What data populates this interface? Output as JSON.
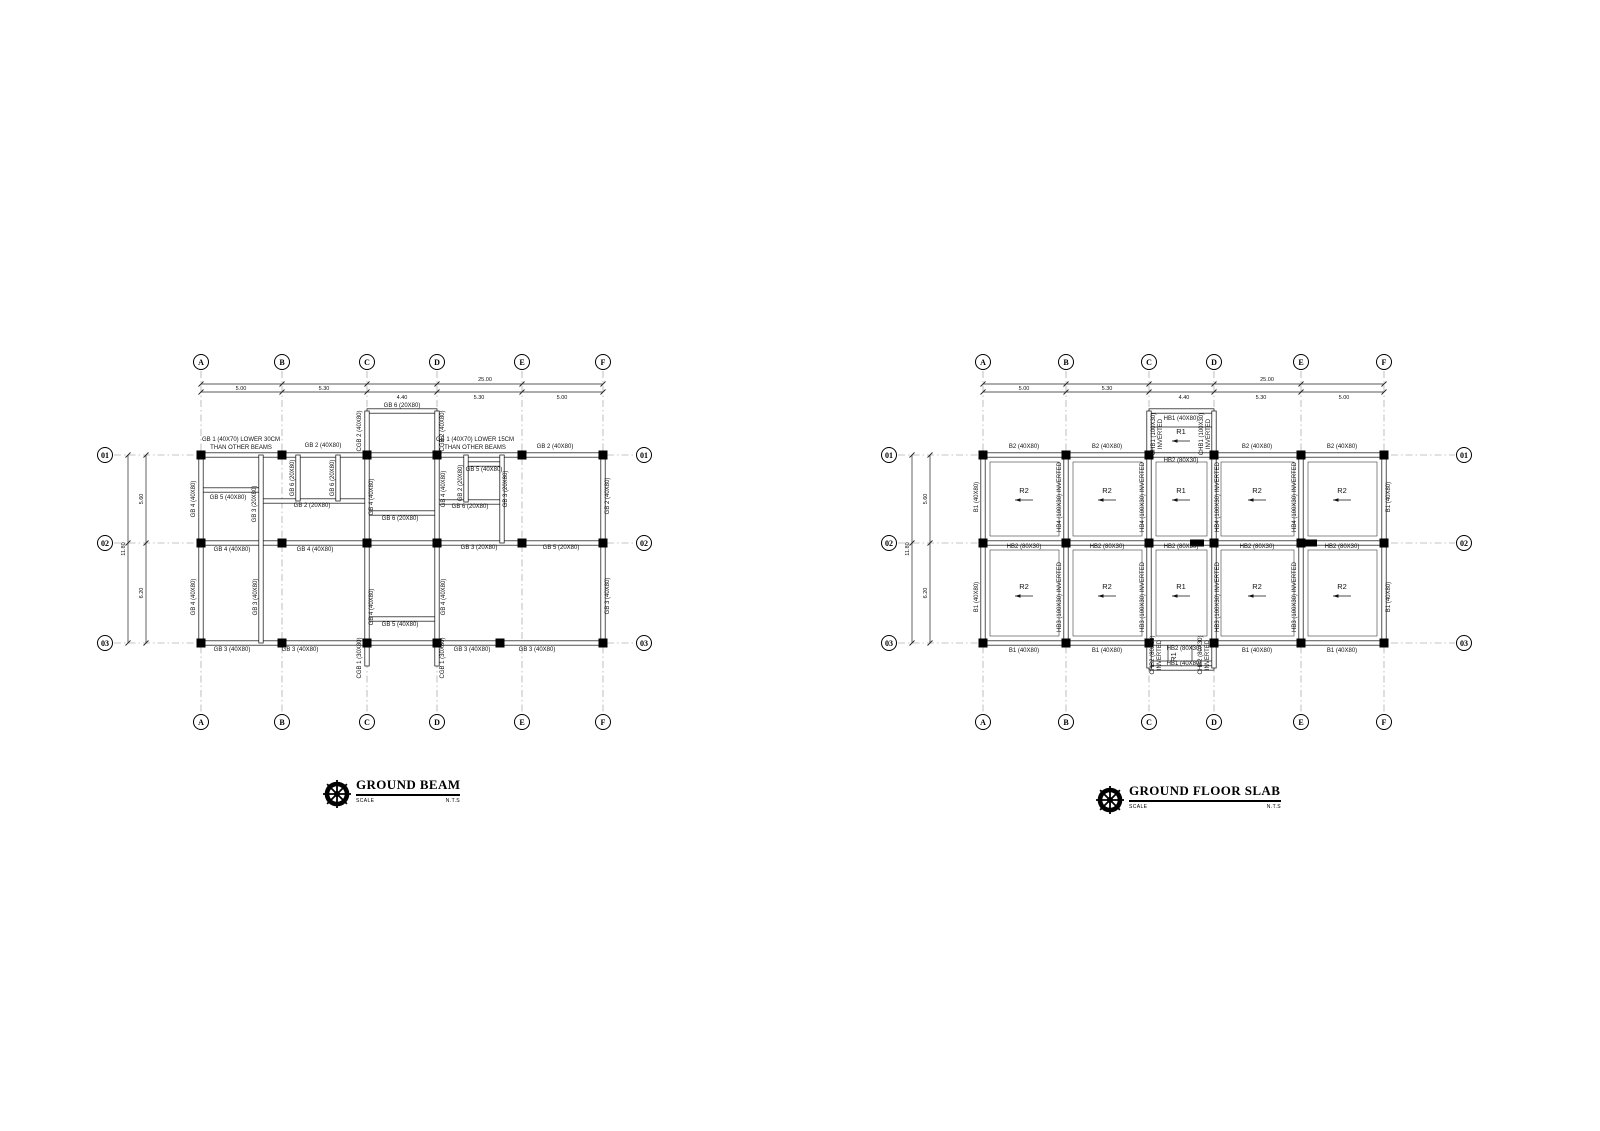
{
  "plans": [
    {
      "name": "GROUND BEAM",
      "scale_label": "SCALE",
      "nts": "N.T.S",
      "grid_columns": [
        "A",
        "B",
        "C",
        "D",
        "E",
        "F"
      ],
      "grid_rows": [
        "01",
        "02",
        "03"
      ],
      "dim_labels": [
        {
          "t": "25.00",
          "x": 485,
          "y": 381
        },
        {
          "t": "5.00",
          "x": 241,
          "y": 390
        },
        {
          "t": "5.30",
          "x": 324,
          "y": 390
        },
        {
          "t": "4.40",
          "x": 402,
          "y": 399
        },
        {
          "t": "5.30",
          "x": 479,
          "y": 399
        },
        {
          "t": "5.00",
          "x": 562,
          "y": 399
        },
        {
          "t": "11.80",
          "x": 125,
          "y": 549,
          "r": -90
        },
        {
          "t": "5.60",
          "x": 143,
          "y": 499,
          "r": -90
        },
        {
          "t": "6.20",
          "x": 143,
          "y": 593,
          "r": -90
        }
      ],
      "beam_labels": [
        {
          "t": "GB 1 (40X70) LOWER 30CM",
          "x": 241,
          "y": 441
        },
        {
          "t": "THAN OTHER BEAMS",
          "x": 241,
          "y": 449
        },
        {
          "t": "GB 2 (40X80)",
          "x": 323,
          "y": 447
        },
        {
          "t": "GB 6 (20X80)",
          "x": 402,
          "y": 407
        },
        {
          "t": "GB 1 (40X70) LOWER 15CM",
          "x": 475,
          "y": 441
        },
        {
          "t": "THAN OTHER BEAMS",
          "x": 475,
          "y": 449
        },
        {
          "t": "GB 2 (40X80)",
          "x": 555,
          "y": 448
        },
        {
          "t": "CGB 2 (40X80)",
          "x": 361,
          "y": 431,
          "r": -90
        },
        {
          "t": "CGB 2 (40X80)",
          "x": 444,
          "y": 431,
          "r": -90
        },
        {
          "t": "GB 4 (40X80)",
          "x": 195,
          "y": 499,
          "r": -90
        },
        {
          "t": "GB 5 (40X80)",
          "x": 228,
          "y": 499
        },
        {
          "t": "GB 3 (20X80)",
          "x": 256,
          "y": 504,
          "r": -90
        },
        {
          "t": "GB 6 (20X80)",
          "x": 294,
          "y": 478,
          "r": -90
        },
        {
          "t": "GB 6 (20X80)",
          "x": 334,
          "y": 478,
          "r": -90
        },
        {
          "t": "GB 2 (20X80)",
          "x": 312,
          "y": 507
        },
        {
          "t": "GB 4 (40X80)",
          "x": 373,
          "y": 497,
          "r": -90
        },
        {
          "t": "GB 6 (20X80)",
          "x": 400,
          "y": 520
        },
        {
          "t": "GB 4 (40X80)",
          "x": 445,
          "y": 489,
          "r": -90
        },
        {
          "t": "GB 5 (40X80)",
          "x": 484,
          "y": 471
        },
        {
          "t": "GB 2 (20X80)",
          "x": 462,
          "y": 483,
          "r": -90
        },
        {
          "t": "GB 6 (20X80)",
          "x": 470,
          "y": 508
        },
        {
          "t": "GB 3 (20X80)",
          "x": 507,
          "y": 489,
          "r": -90
        },
        {
          "t": "GB 2 (40X80)",
          "x": 609,
          "y": 496,
          "r": -90
        },
        {
          "t": "GB 4 (40X80)",
          "x": 232,
          "y": 551
        },
        {
          "t": "GB 4 (40X80)",
          "x": 315,
          "y": 551
        },
        {
          "t": "GB 3 (20X80)",
          "x": 479,
          "y": 549
        },
        {
          "t": "GB 5 (20X80)",
          "x": 561,
          "y": 549
        },
        {
          "t": "GB 4 (40X80)",
          "x": 195,
          "y": 597,
          "r": -90
        },
        {
          "t": "GB 3 (40X80)",
          "x": 257,
          "y": 597,
          "r": -90
        },
        {
          "t": "GB 4 (40X80)",
          "x": 373,
          "y": 607,
          "r": -90
        },
        {
          "t": "GB 5 (40X80)",
          "x": 400,
          "y": 626
        },
        {
          "t": "GB 4 (40X80)",
          "x": 445,
          "y": 597,
          "r": -90
        },
        {
          "t": "GB 3 (40X80)",
          "x": 609,
          "y": 596,
          "r": -90
        },
        {
          "t": "GB 3 (40X80)",
          "x": 232,
          "y": 651
        },
        {
          "t": "GB 3 (40X80)",
          "x": 300,
          "y": 651
        },
        {
          "t": "GB 3 (40X80)",
          "x": 472,
          "y": 651
        },
        {
          "t": "GB 3 (40X80)",
          "x": 537,
          "y": 651
        },
        {
          "t": "CGB 1 (30X80)",
          "x": 361,
          "y": 658,
          "r": -90
        },
        {
          "t": "CGB 1 (30X80)",
          "x": 444,
          "y": 658,
          "r": -90
        }
      ],
      "panels": []
    },
    {
      "name": "GROUND FLOOR SLAB",
      "scale_label": "SCALE",
      "nts": "N.T.S",
      "grid_columns": [
        "A",
        "B",
        "C",
        "D",
        "E",
        "F"
      ],
      "grid_rows": [
        "01",
        "02",
        "03"
      ],
      "dim_labels": [
        {
          "t": "25.00",
          "x": 1267,
          "y": 381
        },
        {
          "t": "5.00",
          "x": 1024,
          "y": 390
        },
        {
          "t": "5.30",
          "x": 1107,
          "y": 390
        },
        {
          "t": "4.40",
          "x": 1184,
          "y": 399
        },
        {
          "t": "5.30",
          "x": 1261,
          "y": 399
        },
        {
          "t": "5.00",
          "x": 1344,
          "y": 399
        },
        {
          "t": "11.80",
          "x": 909,
          "y": 549,
          "r": -90
        },
        {
          "t": "5.60",
          "x": 927,
          "y": 499,
          "r": -90
        },
        {
          "t": "6.20",
          "x": 927,
          "y": 593,
          "r": -90
        }
      ],
      "beam_labels": [
        {
          "t": "B2 (40X80)",
          "x": 1024,
          "y": 448
        },
        {
          "t": "B2 (40X80)",
          "x": 1107,
          "y": 448
        },
        {
          "t": "B2 (40X80)",
          "x": 1257,
          "y": 448
        },
        {
          "t": "B2 (40X80)",
          "x": 1342,
          "y": 448
        },
        {
          "t": "HB1 (40X80)",
          "x": 1181,
          "y": 420
        },
        {
          "t": "CHB1 (100X30)",
          "x": 1155,
          "y": 434,
          "r": -90
        },
        {
          "t": "INVERTED",
          "x": 1162,
          "y": 434,
          "r": -90
        },
        {
          "t": "CHB1 (100X30)",
          "x": 1203,
          "y": 434,
          "r": -90
        },
        {
          "t": "INVERTED",
          "x": 1210,
          "y": 434,
          "r": -90
        },
        {
          "t": "HB2 (80X30)",
          "x": 1181,
          "y": 462
        },
        {
          "t": "B1 (40X80)",
          "x": 978,
          "y": 497,
          "r": -90
        },
        {
          "t": "HB4 (100X30) INVERTED",
          "x": 1061,
          "y": 497,
          "r": -90
        },
        {
          "t": "HB4 (100X30) INVERTED",
          "x": 1144,
          "y": 497,
          "r": -90
        },
        {
          "t": "HB4 (100X30) INVERTED",
          "x": 1219,
          "y": 497,
          "r": -90
        },
        {
          "t": "HB4 (100X30) INVERTED",
          "x": 1296,
          "y": 497,
          "r": -90
        },
        {
          "t": "B1 (40X80)",
          "x": 1390,
          "y": 497,
          "r": -90
        },
        {
          "t": "HB2 (80X30)",
          "x": 1024,
          "y": 548
        },
        {
          "t": "HB2 (80X30)",
          "x": 1107,
          "y": 548
        },
        {
          "t": "HB2 (80X30)",
          "x": 1181,
          "y": 548
        },
        {
          "t": "HB2 (80X30)",
          "x": 1257,
          "y": 548
        },
        {
          "t": "HB2 (80X30)",
          "x": 1342,
          "y": 548
        },
        {
          "t": "B1 (40X80)",
          "x": 978,
          "y": 597,
          "r": -90
        },
        {
          "t": "HB3 (100X30) INVERTED",
          "x": 1061,
          "y": 597,
          "r": -90
        },
        {
          "t": "HB3 (100X30) INVERTED",
          "x": 1144,
          "y": 597,
          "r": -90
        },
        {
          "t": "HB3 (100X30) INVERTED",
          "x": 1219,
          "y": 597,
          "r": -90
        },
        {
          "t": "HB3 (100X30) INVERTED",
          "x": 1296,
          "y": 597,
          "r": -90
        },
        {
          "t": "B1 (40X80)",
          "x": 1390,
          "y": 597,
          "r": -90
        },
        {
          "t": "B1 (40X80)",
          "x": 1024,
          "y": 652
        },
        {
          "t": "B1 (40X80)",
          "x": 1107,
          "y": 652
        },
        {
          "t": "B1 (40X80)",
          "x": 1257,
          "y": 652
        },
        {
          "t": "B1 (40X80)",
          "x": 1342,
          "y": 652
        },
        {
          "t": "HB2 (80X30)",
          "x": 1184,
          "y": 650
        },
        {
          "t": "HB1 (40X80)",
          "x": 1184,
          "y": 665
        },
        {
          "t": "CHB2 (80X30)",
          "x": 1154,
          "y": 655,
          "r": -90
        },
        {
          "t": "INVERTED",
          "x": 1161,
          "y": 655,
          "r": -90
        },
        {
          "t": "CHB2 (80X30)",
          "x": 1202,
          "y": 655,
          "r": -90
        },
        {
          "t": "INVERTED",
          "x": 1209,
          "y": 655,
          "r": -90
        }
      ],
      "panels": [
        {
          "t": "R1",
          "x": 1181,
          "y": 434,
          "arrow": true
        },
        {
          "t": "R2",
          "x": 1024,
          "y": 493,
          "arrow": true
        },
        {
          "t": "R2",
          "x": 1107,
          "y": 493,
          "arrow": true
        },
        {
          "t": "R1",
          "x": 1181,
          "y": 493,
          "arrow": true
        },
        {
          "t": "R2",
          "x": 1257,
          "y": 493,
          "arrow": true
        },
        {
          "t": "R2",
          "x": 1342,
          "y": 493,
          "arrow": true
        },
        {
          "t": "R2",
          "x": 1024,
          "y": 589,
          "arrow": true
        },
        {
          "t": "R2",
          "x": 1107,
          "y": 589,
          "arrow": true
        },
        {
          "t": "R1",
          "x": 1181,
          "y": 589,
          "arrow": true
        },
        {
          "t": "R2",
          "x": 1257,
          "y": 589,
          "arrow": true
        },
        {
          "t": "R2",
          "x": 1342,
          "y": 589,
          "arrow": true
        },
        {
          "t": "R1",
          "x": 1176,
          "y": 657,
          "r": -90
        }
      ]
    }
  ]
}
